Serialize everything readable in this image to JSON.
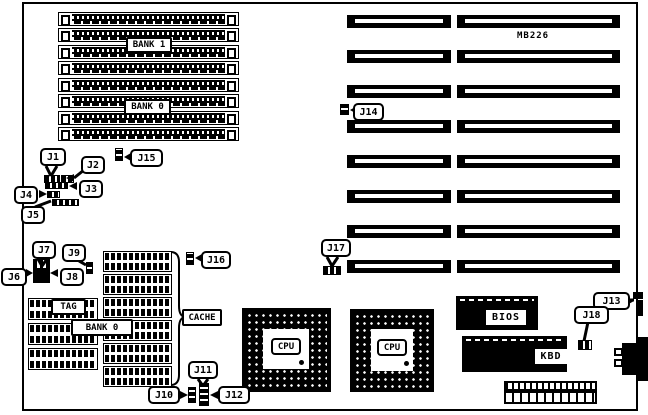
{
  "board": {
    "model_label": "MB226",
    "memory": {
      "simm_slots": 8,
      "bank1_label": "BANK 1",
      "bank0_label": "BANK 0"
    },
    "expansion": {
      "isa_slots": 16
    },
    "cache_area": {
      "tag_label": "TAG",
      "bank0_label": "BANK 0",
      "cache_label": "CACHE"
    },
    "processors": {
      "cpu1_label": "CPU",
      "cpu2_label": "CPU"
    },
    "chips": {
      "bios_label": "BIOS",
      "kbd_label": "KBD"
    },
    "jumpers": {
      "J1": "J1",
      "J2": "J2",
      "J3": "J3",
      "J4": "J4",
      "J5": "J5",
      "J6": "J6",
      "J7": "J7",
      "J8": "J8",
      "J9": "J9",
      "J10": "J10",
      "J11": "J11",
      "J12": "J12",
      "J13": "J13",
      "J14": "J14",
      "J15": "J15",
      "J16": "J16",
      "J17": "J17",
      "J18": "J18"
    },
    "colors": {
      "ink": "#000000",
      "background": "#ffffff"
    }
  }
}
